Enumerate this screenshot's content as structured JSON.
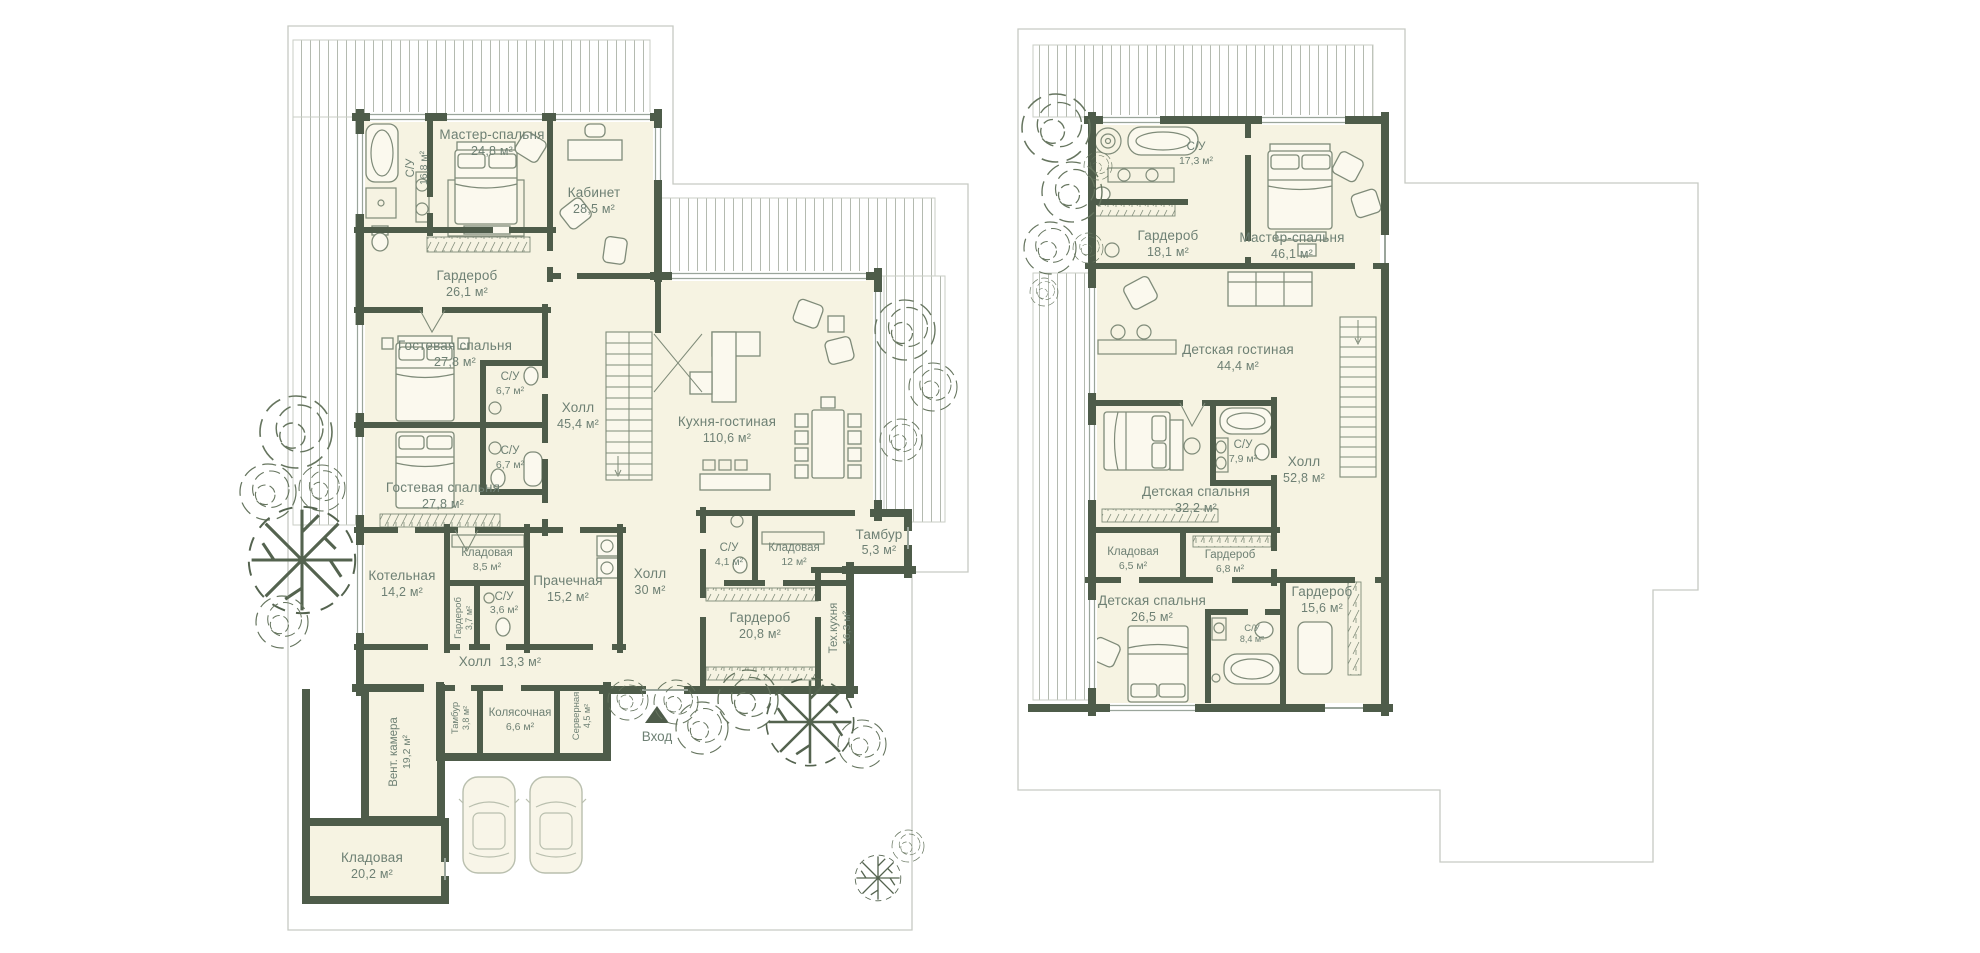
{
  "colors": {
    "background": "#ffffff",
    "wall": "#4e5c4a",
    "room_fill": "#f6f3e2",
    "label": "#6e8074",
    "deck_line": "#b4bab0",
    "site_outline": "#c6cac3",
    "tree": "#5d6c57"
  },
  "floor1": {
    "entrance_label": "Вход",
    "rooms": {
      "su_master": {
        "label": "С/У",
        "area": "16,8 м²"
      },
      "master": {
        "label": "Мастер-спальня",
        "area": "24,8 м²"
      },
      "kabinet": {
        "label": "Кабинет",
        "area": "28,5 м²"
      },
      "garderob26": {
        "label": "Гардероб",
        "area": "26,1 м²"
      },
      "guest1": {
        "label": "Гостевая спальня",
        "area": "27,8 м²"
      },
      "su67a": {
        "label": "С/У",
        "area": "6,7 м²"
      },
      "hall454": {
        "label": "Холл",
        "area": "45,4 м²"
      },
      "kitchen": {
        "label": "Кухня-гостиная",
        "area": "110,6 м²"
      },
      "su67b": {
        "label": "С/У",
        "area": "6,7 м²"
      },
      "guest2": {
        "label": "Гостевая спальня",
        "area": "27,8 м²"
      },
      "kotelnaya": {
        "label": "Котельная",
        "area": "14,2 м²"
      },
      "kladovaya85": {
        "label": "Кладовая",
        "area": "8,5 м²"
      },
      "garderob37": {
        "label": "Гардероб",
        "area": "3,7 м²"
      },
      "su36": {
        "label": "С/У",
        "area": "3,6 м²"
      },
      "prachechnaya": {
        "label": "Прачечная",
        "area": "15,2 м²"
      },
      "hall30": {
        "label": "Холл",
        "area": "30 м²"
      },
      "su41": {
        "label": "С/У",
        "area": "4,1 м²"
      },
      "kladovaya12": {
        "label": "Кладовая",
        "area": "12 м²"
      },
      "tambur53": {
        "label": "Тамбур",
        "area": "5,3 м²"
      },
      "garderob208": {
        "label": "Гардероб",
        "area": "20,8 м²"
      },
      "tehkuhnya": {
        "label": "Тех.кухня",
        "area": "16,3 м²"
      },
      "hall133": {
        "label": "Холл",
        "area": "13,3 м²"
      },
      "tambur38": {
        "label": "Тамбур",
        "area": "3,8 м²"
      },
      "kolyasochnaya": {
        "label": "Колясочная",
        "area": "6,6 м²"
      },
      "servernaya": {
        "label": "Серверная",
        "area": "4,5 м²"
      },
      "ventkamera": {
        "label": "Вент. камера",
        "area": "19,2 м²"
      },
      "kladovaya202": {
        "label": "Кладовая",
        "area": "20,2 м²"
      }
    }
  },
  "floor2": {
    "rooms": {
      "su173": {
        "label": "С/У",
        "area": "17,3 м²"
      },
      "garderob181": {
        "label": "Гардероб",
        "area": "18,1 м²"
      },
      "master": {
        "label": "Мастер-спальня",
        "area": "46,1 м²"
      },
      "kidsliving": {
        "label": "Детская гостиная",
        "area": "44,4 м²"
      },
      "su79": {
        "label": "С/У",
        "area": "7,9 м²"
      },
      "hall528": {
        "label": "Холл",
        "area": "52,8 м²"
      },
      "kids1": {
        "label": "Детская спальня",
        "area": "32,2 м²"
      },
      "kladovaya65": {
        "label": "Кладовая",
        "area": "6,5 м²"
      },
      "garderob68": {
        "label": "Гардероб",
        "area": "6,8 м²"
      },
      "kids2": {
        "label": "Детская спальня",
        "area": "26,5 м²"
      },
      "su84": {
        "label": "С/У",
        "area": "8,4 м²"
      },
      "garderob156": {
        "label": "Гардероб",
        "area": "15,6 м²"
      }
    }
  }
}
